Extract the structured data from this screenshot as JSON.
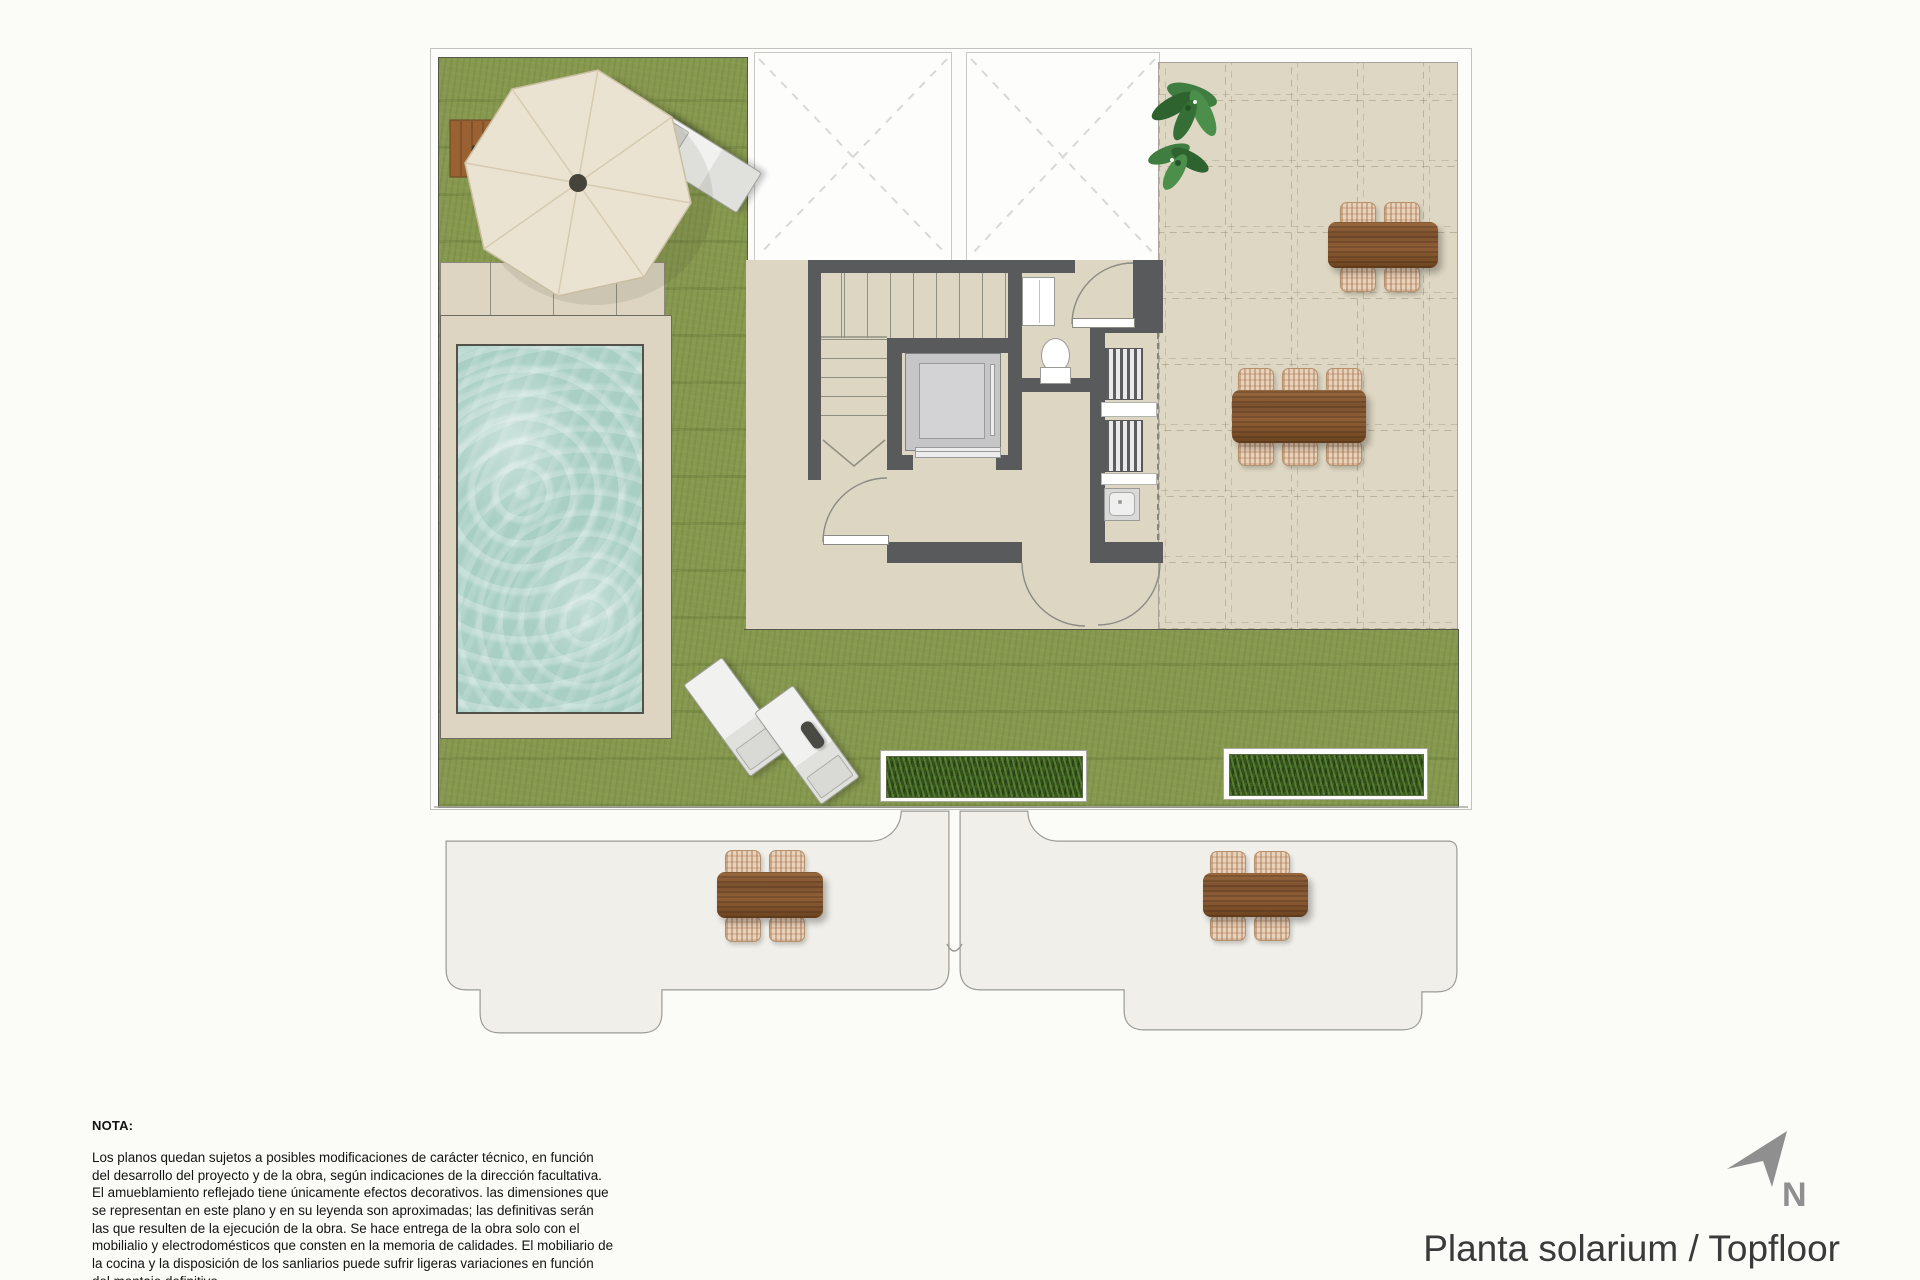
{
  "title": {
    "text": "Planta solarium / Topfloor"
  },
  "compass": {
    "label": "N",
    "icon": "north-arrow"
  },
  "note": {
    "heading": "NOTA:",
    "body": "Los planos quedan sujetos a posibles modificaciones de carácter técnico, en función del desarrollo del proyecto y de la obra, según indicaciones de la dirección facultativa. El amueblamiento reflejado tiene únicamente efectos decorativos. las dimensiones que se representan en este plano y en su leyenda son aproximadas; las definitivas serán las que resulten de la ejecución de la obra. Se hace entrega de la obra solo con el mobilialio y electrodomésticos que consten en la memoria de calidades. El mobiliario de la cocina y la disposición de los sanliarios puede sufrir ligeras variaciones en función del montaje definitivo."
  },
  "plan": {
    "colors": {
      "grass": "#87984f",
      "terrace_tile": "#ded7c3",
      "wall": "#595a5c",
      "pool_water": "#a9cfc5",
      "pool_deck": "#ddd5c1",
      "wood_furniture": "#8a5a35",
      "wicker_chair": "#e9d2bc",
      "lower_terrace": "#f1efe9",
      "umbrella_canopy": "#ebe3d1",
      "planter_plants": "#35501f"
    },
    "features": [
      "roof-garden",
      "pool",
      "parasol",
      "sun-loungers",
      "stairs",
      "elevator",
      "toilet",
      "washbasin",
      "machinery-room",
      "outdoor-dining-tables",
      "planters",
      "lower-floor-terraces"
    ]
  }
}
